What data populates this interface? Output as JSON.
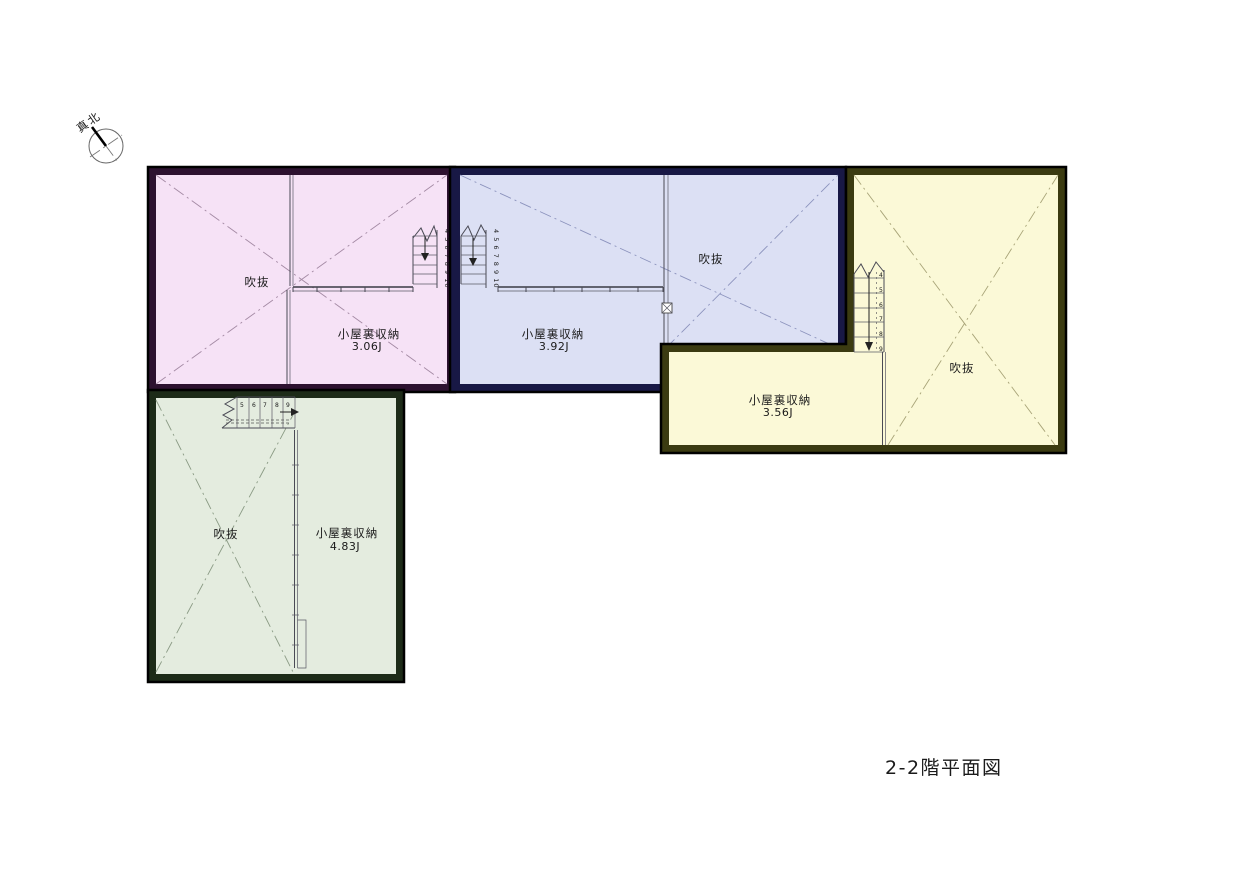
{
  "title": "2-2階平面図",
  "north": {
    "label": "真北"
  },
  "regions": {
    "pink": {
      "fill": "#f6e2f6",
      "border": "#2d1230",
      "diag": "#a48aa4",
      "void_label": "吹抜",
      "storage_label": "小屋裏収納",
      "storage_area": "3.06J",
      "stair_numbers": "4 5 6 7 8 9 10"
    },
    "blue": {
      "fill": "#dce0f4",
      "border": "#181845",
      "diag": "#8c93bd",
      "void_label": "吹抜",
      "storage_label": "小屋裏収納",
      "storage_area": "3.92J",
      "stair_numbers": "4 5 6 7 8 9 10"
    },
    "yellow": {
      "fill": "#fbf9d7",
      "border": "#3b3b11",
      "diag": "#a8a478",
      "void_label": "吹抜",
      "storage_label": "小屋裏収納",
      "storage_area": "3.56J",
      "stair_numbers": [
        "4",
        "5",
        "6",
        "7",
        "8",
        "9"
      ]
    },
    "green": {
      "fill": "#e4ecdf",
      "border": "#1d2b18",
      "diag": "#8a9a84",
      "void_label": "吹抜",
      "storage_label": "小屋裏収納",
      "storage_area": "4.83J",
      "stair_numbers": [
        "5",
        "6",
        "7",
        "8",
        "9"
      ]
    }
  }
}
